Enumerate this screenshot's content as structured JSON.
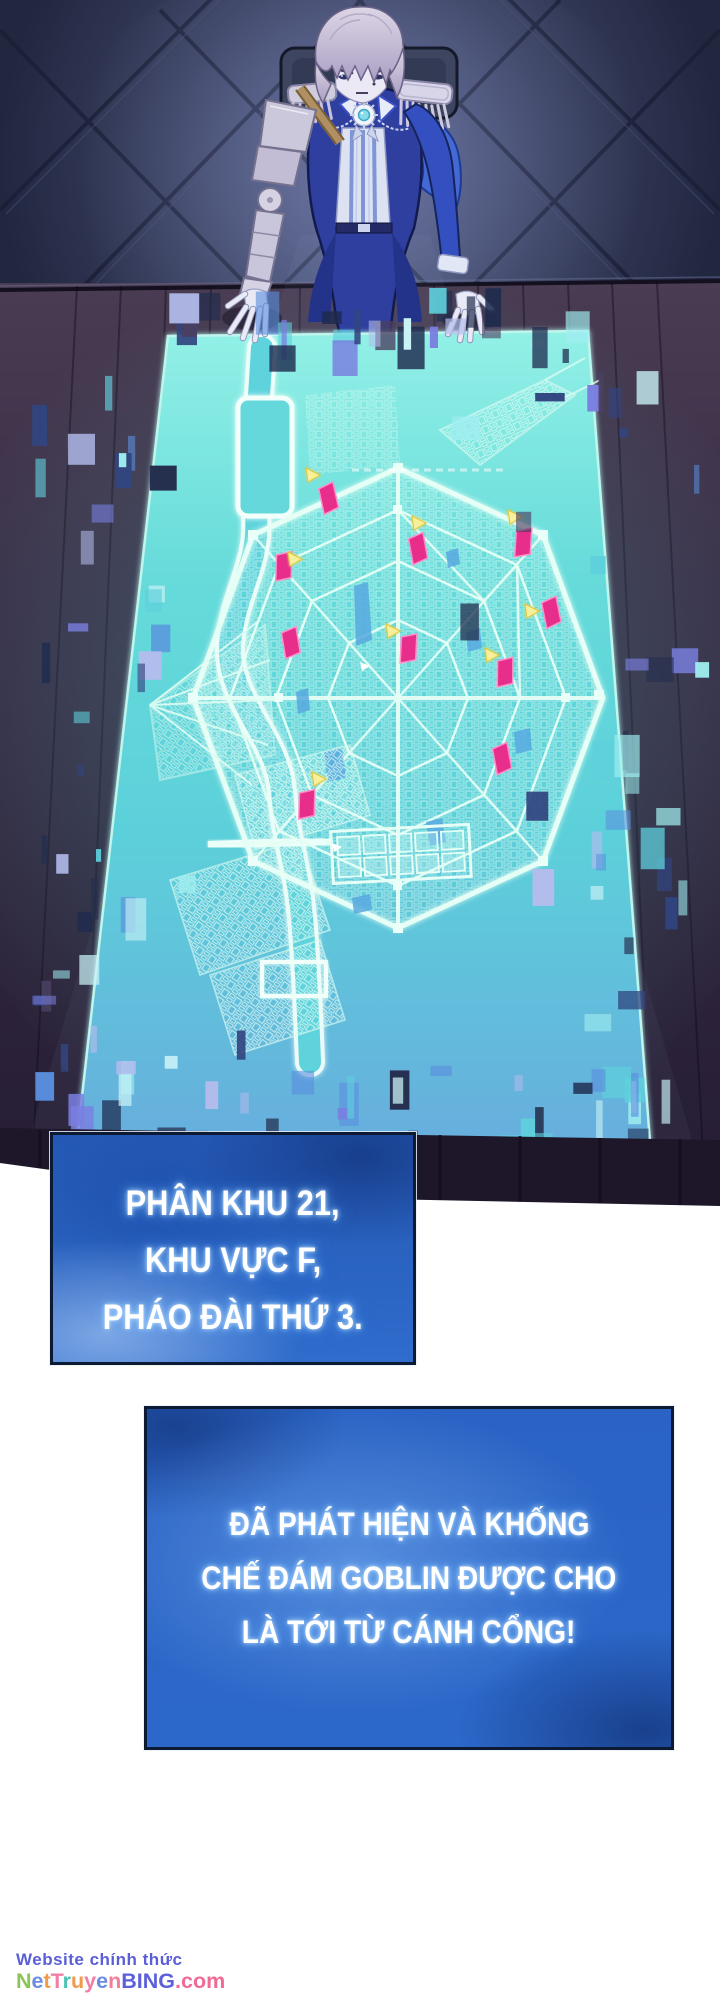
{
  "speech_boxes": [
    {
      "lines": [
        "PHÂN KHU 21,",
        "KHU VỰC F,",
        "PHÁO ĐÀI THỨ 3."
      ]
    },
    {
      "lines": [
        "ĐÃ PHÁT HIỆN VÀ KHỐNG",
        "CHẾ ĐÁM GOBLIN ĐƯỢC CHO",
        "LÀ TỚI TỪ CÁNH CỔNG!"
      ]
    }
  ],
  "watermark": {
    "line1": "Website chính thức",
    "line1_color": "#5a5fd8",
    "line2_letters": [
      {
        "ch": "N",
        "color": "#8bc558"
      },
      {
        "ch": "e",
        "color": "#6b8de0"
      },
      {
        "ch": "t",
        "color": "#f09a4a"
      },
      {
        "ch": "T",
        "color": "#f07fa8"
      },
      {
        "ch": "r",
        "color": "#4cc2b4"
      },
      {
        "ch": "u",
        "color": "#f09a4a"
      },
      {
        "ch": "y",
        "color": "#f07fa8"
      },
      {
        "ch": "e",
        "color": "#6b8de0"
      },
      {
        "ch": "n",
        "color": "#ef7f9a"
      },
      {
        "ch": "B",
        "color": "#5c60dc"
      },
      {
        "ch": "I",
        "color": "#5c60dc"
      },
      {
        "ch": "N",
        "color": "#5c60dc"
      },
      {
        "ch": "G",
        "color": "#5c60dc"
      },
      {
        "ch": ".",
        "color": "#ef6a95"
      },
      {
        "ch": "c",
        "color": "#ef6a95"
      },
      {
        "ch": "o",
        "color": "#ef6a95"
      },
      {
        "ch": "m",
        "color": "#ef6a95"
      }
    ]
  },
  "colors": {
    "map_cyan": "#62d8d8",
    "map_line": "#e6fff6",
    "marker_pink": "#e62e8a",
    "marker_pink_edge": "#ff8fc8",
    "marker_yellow": "#f7ef9a",
    "marker_yellow_edge": "#dcc83e",
    "speech_blue": "#2a63c4",
    "glitch_palette": [
      "#9feef0",
      "#5fd0dc",
      "#5a8ede",
      "#7a7fe0",
      "#32457f",
      "#1d2a4d",
      "#c9f2f6",
      "#b3bcec",
      "#4a3f60",
      "#25304f"
    ]
  },
  "map": {
    "markers": {
      "pink": [
        {
          "x": 318,
          "y": 484,
          "r": -8
        },
        {
          "x": 277,
          "y": 550,
          "r": 6
        },
        {
          "x": 408,
          "y": 534,
          "r": -6
        },
        {
          "x": 517,
          "y": 526,
          "r": 8
        },
        {
          "x": 281,
          "y": 628,
          "r": -5
        },
        {
          "x": 402,
          "y": 632,
          "r": 7
        },
        {
          "x": 541,
          "y": 598,
          "r": -7
        },
        {
          "x": 498,
          "y": 656,
          "r": 5
        },
        {
          "x": 492,
          "y": 744,
          "r": -6
        },
        {
          "x": 300,
          "y": 788,
          "r": 6
        }
      ],
      "yellow": [
        {
          "x": 306,
          "y": 468
        },
        {
          "x": 288,
          "y": 552
        },
        {
          "x": 412,
          "y": 516
        },
        {
          "x": 508,
          "y": 510
        },
        {
          "x": 386,
          "y": 624
        },
        {
          "x": 525,
          "y": 604
        },
        {
          "x": 485,
          "y": 648
        },
        {
          "x": 312,
          "y": 772
        }
      ],
      "white": [
        {
          "x": 360,
          "y": 662
        },
        {
          "x": 332,
          "y": 843
        }
      ]
    }
  }
}
